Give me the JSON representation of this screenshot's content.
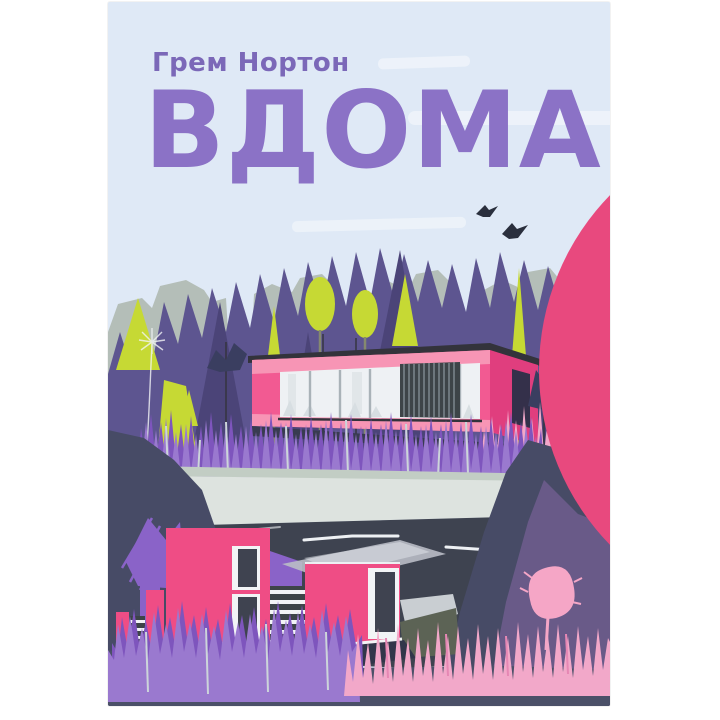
{
  "cover": {
    "author": "Грем Нортон",
    "title": "ВДОМА",
    "logo_icon": "publisher-logo-icon",
    "scene_elements": [
      "sky",
      "cloud-streaks",
      "two-birds",
      "gray-treeline",
      "purple-treeline",
      "lime-trees",
      "dandelion-sketch",
      "modern-pink-house",
      "glass-facade",
      "louver-panel",
      "purple-grass",
      "pink-grass",
      "pale-terrace",
      "dark-road",
      "navy-hills",
      "purple-hill",
      "pink-tree",
      "lower-pink-house",
      "striped-stairs",
      "ground"
    ]
  },
  "colors": {
    "pageBg": "#ffffff",
    "sky": "#dfe9f6",
    "cloud": "#f4f8fc",
    "bird": "#2a2f3d",
    "treeGray": "#b4beb8",
    "treePurple": "#5d5590",
    "treePurpleDark": "#4b4478",
    "lime": "#c6d934",
    "trunk": "#85896f",
    "bushNavy": "#3a3e60",
    "bushPurple": "#8a63c8",
    "housePink": "#f25a92",
    "housePinkLight": "#f795b5",
    "houseMagenta": "#e03e7e",
    "roofDark": "#33333b",
    "windowWhite": "#eef1f4",
    "windowDivider": "#a9b2b8",
    "louverDark": "#3d4448",
    "louverLine": "#8d989e",
    "grassPurple": "#9a79cf",
    "grassPurpleDark": "#7e55bd",
    "bladeLight": "#ccd4da",
    "grassPink": "#f2a8c9",
    "grassPinkDark": "#e687b4",
    "terrace": "#dde3df",
    "terraceDark": "#c2cdc4",
    "road": "#3e4350",
    "roadLine": "#eef1f4",
    "hillNavy": "#474b66",
    "hillPurple": "#695a88",
    "treePink": "#f5a6c6",
    "lowerPink": "#ef4d85",
    "winDark": "#3f4350",
    "white": "#f2f4f6",
    "sage": "#5c6355",
    "ground": "#4b5068",
    "title": "#8b72c6",
    "author": "#7b68b8",
    "logoPink": "#e8497e"
  }
}
